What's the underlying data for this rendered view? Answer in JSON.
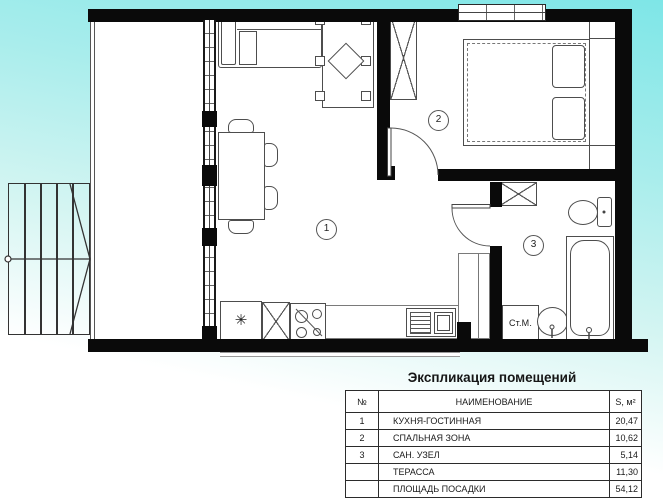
{
  "title": "Экспликация помещений",
  "plan": {
    "rooms": [
      {
        "number": "1",
        "name": "КУХНЯ-ГОСТИННАЯ"
      },
      {
        "number": "2",
        "name": "СПАЛЬНАЯ ЗОНА"
      },
      {
        "number": "3",
        "name": "САН. УЗЕЛ"
      }
    ],
    "washer_label": "Ст.М.",
    "fridge_symbol": "✳"
  },
  "table": {
    "headers": {
      "num": "№",
      "name": "НАИМЕНОВАНИЕ",
      "area": "S, м²"
    },
    "rows": [
      {
        "num": "1",
        "name": "КУХНЯ-ГОСТИННАЯ",
        "area": "20,47"
      },
      {
        "num": "2",
        "name": "СПАЛЬНАЯ ЗОНА",
        "area": "10,62"
      },
      {
        "num": "3",
        "name": "САН. УЗЕЛ",
        "area": "5,14"
      },
      {
        "num": "",
        "name": "ТЕРАССА",
        "area": "11,30"
      },
      {
        "num": "",
        "name": "ПЛОЩАДЬ ПОСАДКИ",
        "area": "54,12"
      }
    ]
  },
  "colors": {
    "background_top": "#7ee6e7",
    "background_bottom": "#ffffff",
    "wall": "#0a0a0a",
    "furniture_line": "#4d4d4d"
  }
}
